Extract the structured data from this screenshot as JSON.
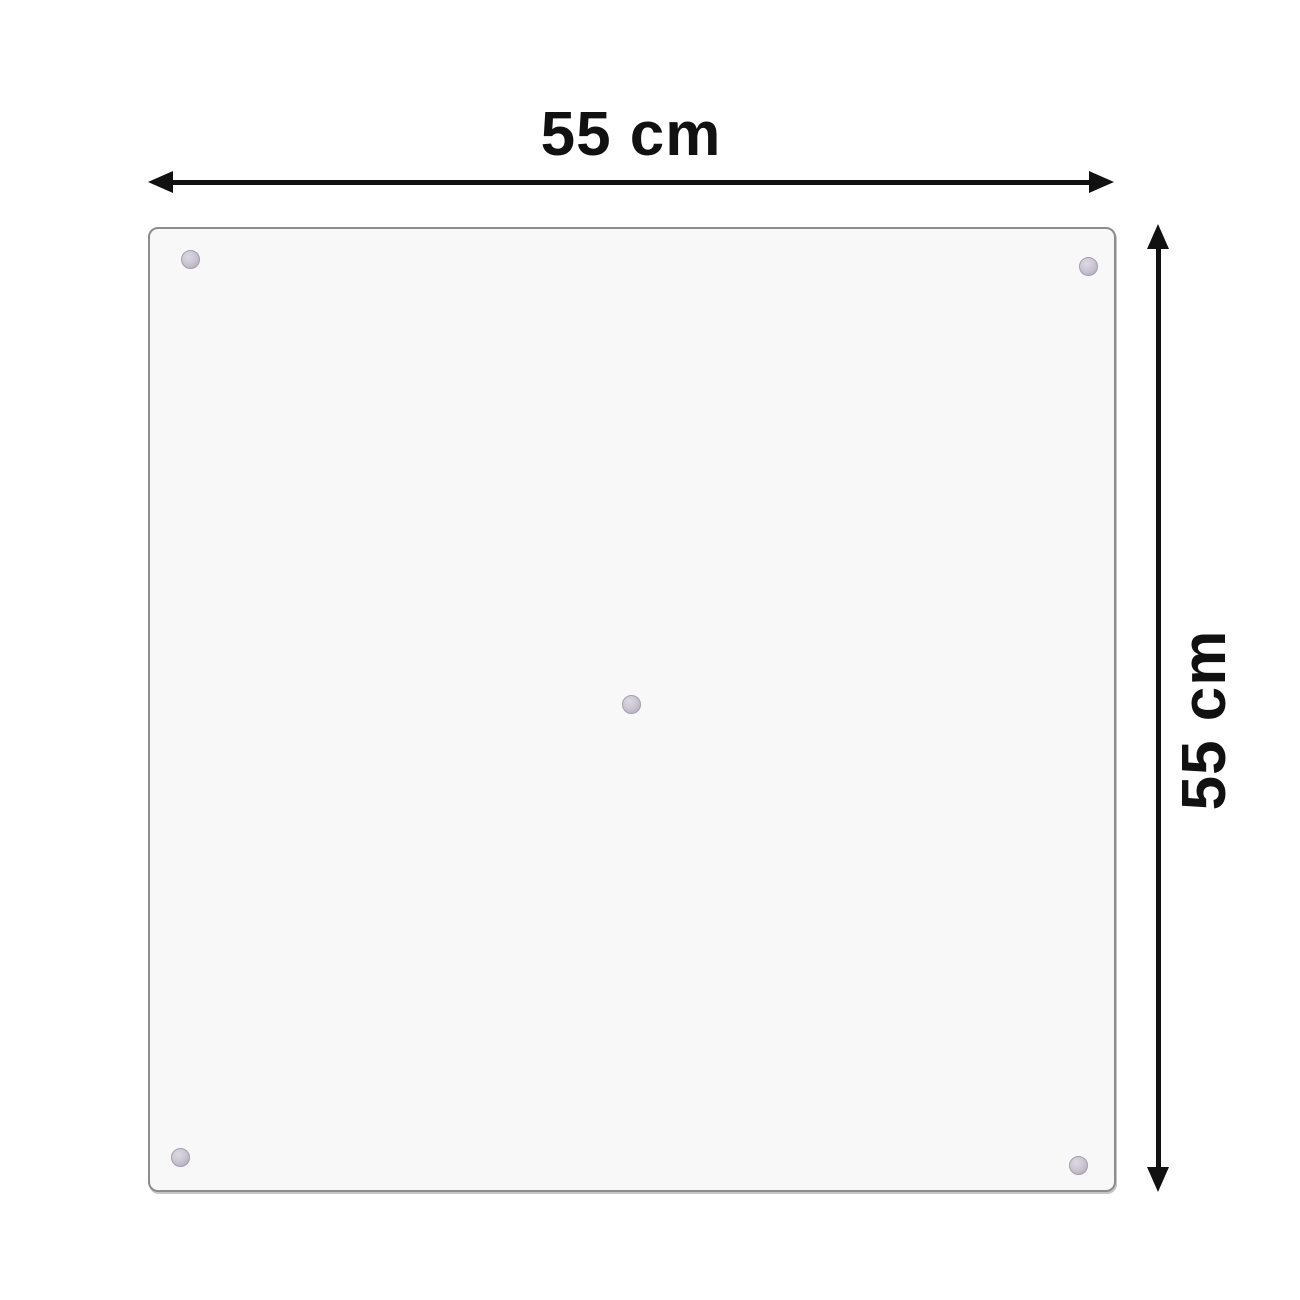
{
  "diagram": {
    "type": "product-dimension-diagram",
    "width_label": "55 cm",
    "height_label": "55 cm",
    "panel": {
      "shape": "square",
      "suction_cup_count": 5,
      "suction_cup_positions": [
        "top-left",
        "top-right",
        "center",
        "bottom-left",
        "bottom-right"
      ]
    },
    "colors": {
      "background": "#ffffff",
      "arrow": "#111111",
      "label_text": "#111111",
      "panel_fill": "#f8f8f8",
      "panel_border": "#8d8d8d",
      "suction_cup_outer": "#aea7ba",
      "suction_cup_inner": "#ddd9e3"
    }
  }
}
